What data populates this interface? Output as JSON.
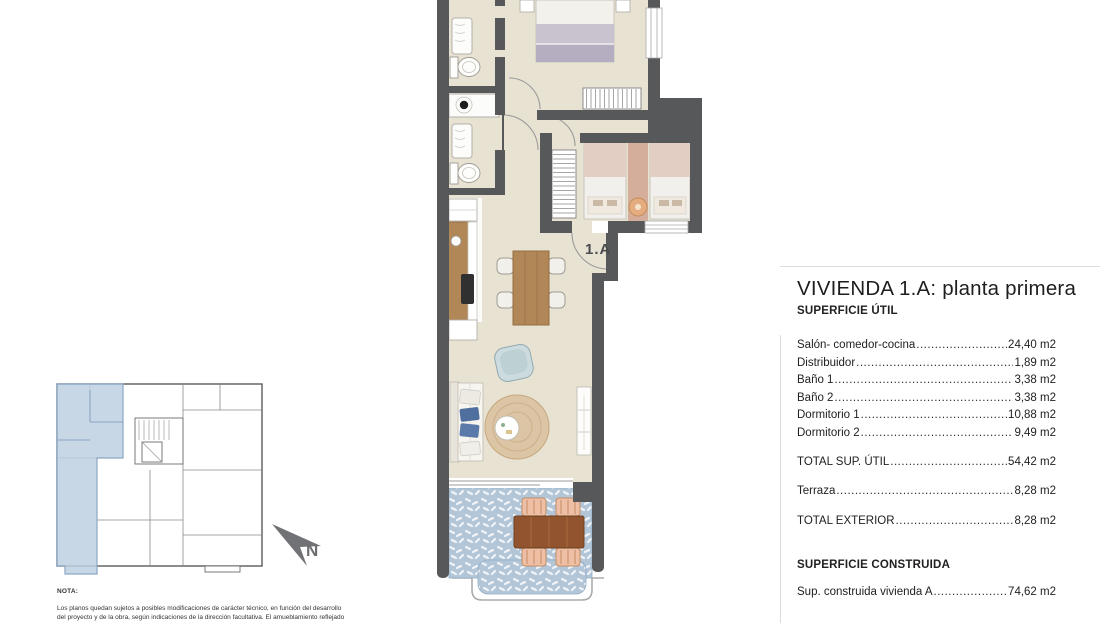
{
  "plan": {
    "unit_label": "1.A",
    "north_label": "N"
  },
  "panel": {
    "title": "VIVIENDA 1.A: planta primera",
    "section_util": "SUPERFICIE ÚTIL",
    "rows_util": [
      {
        "label": "Salón- comedor-cocina",
        "value": "24,40 m2"
      },
      {
        "label": "Distribuidor",
        "value": "1,89 m2"
      },
      {
        "label": "Baño 1",
        "value": "3,38 m2"
      },
      {
        "label": "Baño 2",
        "value": "3,38 m2"
      },
      {
        "label": "Dormitorio 1",
        "value": "10,88 m2"
      },
      {
        "label": "Dormitorio 2",
        "value": "9,49 m2"
      }
    ],
    "row_total_util": {
      "label": "TOTAL SUP. ÚTIL",
      "value": "54,42 m2"
    },
    "row_terraza": {
      "label": "Terraza",
      "value": "8,28 m2"
    },
    "row_total_exterior": {
      "label": "TOTAL EXTERIOR",
      "value": "8,28 m2"
    },
    "section_construida": "SUPERFICIE CONSTRUIDA",
    "row_construida": {
      "label": "Sup. construida vivienda A",
      "value": "74,62 m2"
    }
  },
  "note": {
    "heading": "NOTA:",
    "line1": "Los planos quedan sujetos a posibles modificaciones de carácter técnico, en función del desarrollo",
    "line2": "del proyecto y de la obra, según indicaciones de la dirección facultativa. El amueblamiento reflejado"
  },
  "colors": {
    "wall": "#57585a",
    "floor": "#e8e2d3",
    "terrace_tile": "#b3c6d8",
    "highlight_blue": "#bdd0e2",
    "wood": "#b18757",
    "terrace_wood": "#91542e",
    "text_dark": "#232021"
  }
}
